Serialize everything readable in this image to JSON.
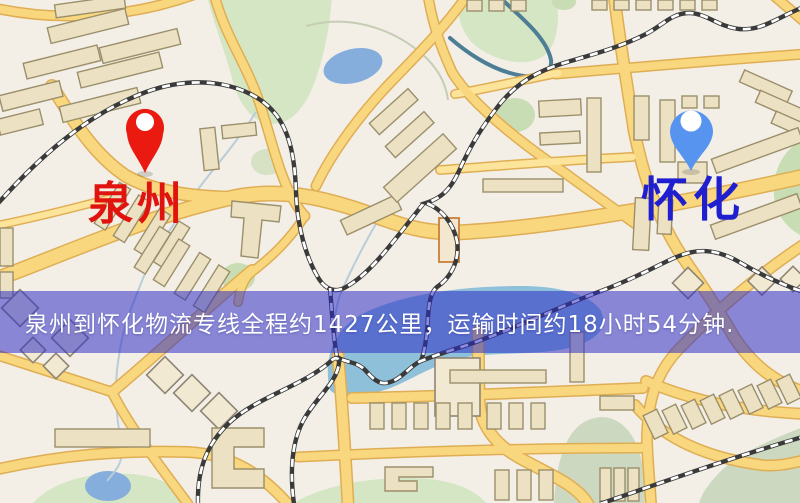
{
  "map": {
    "origin": {
      "label": "泉州",
      "pin_color": "#ea1a10",
      "label_color": "#e0130e"
    },
    "destination": {
      "label": "怀化",
      "pin_color": "#5794f0",
      "label_color": "#1f1fd0"
    },
    "banner": {
      "text": "泉州到怀化物流专线全程约1427公里，运输时间约18小时54分钟.",
      "background_color": "rgba(45,44,197,0.54)",
      "text_color": "#ffffff",
      "route": {
        "origin": "泉州",
        "destination": "怀化",
        "service": "物流专线",
        "distance_text": "约1427公里",
        "duration_text": "约18小时54分钟"
      }
    },
    "palette": {
      "map_background": "#f3efe7",
      "road_fill": "#f8d77e",
      "road_casing": "#dfae54",
      "building_fill": "#ece2c3",
      "building_stroke": "#9b8f6b",
      "park_green": "#d4e6c3",
      "pond_blue": "#85aedd",
      "lake_blue": "#8fc0da",
      "railway_dark": "#3a3a3a"
    }
  }
}
